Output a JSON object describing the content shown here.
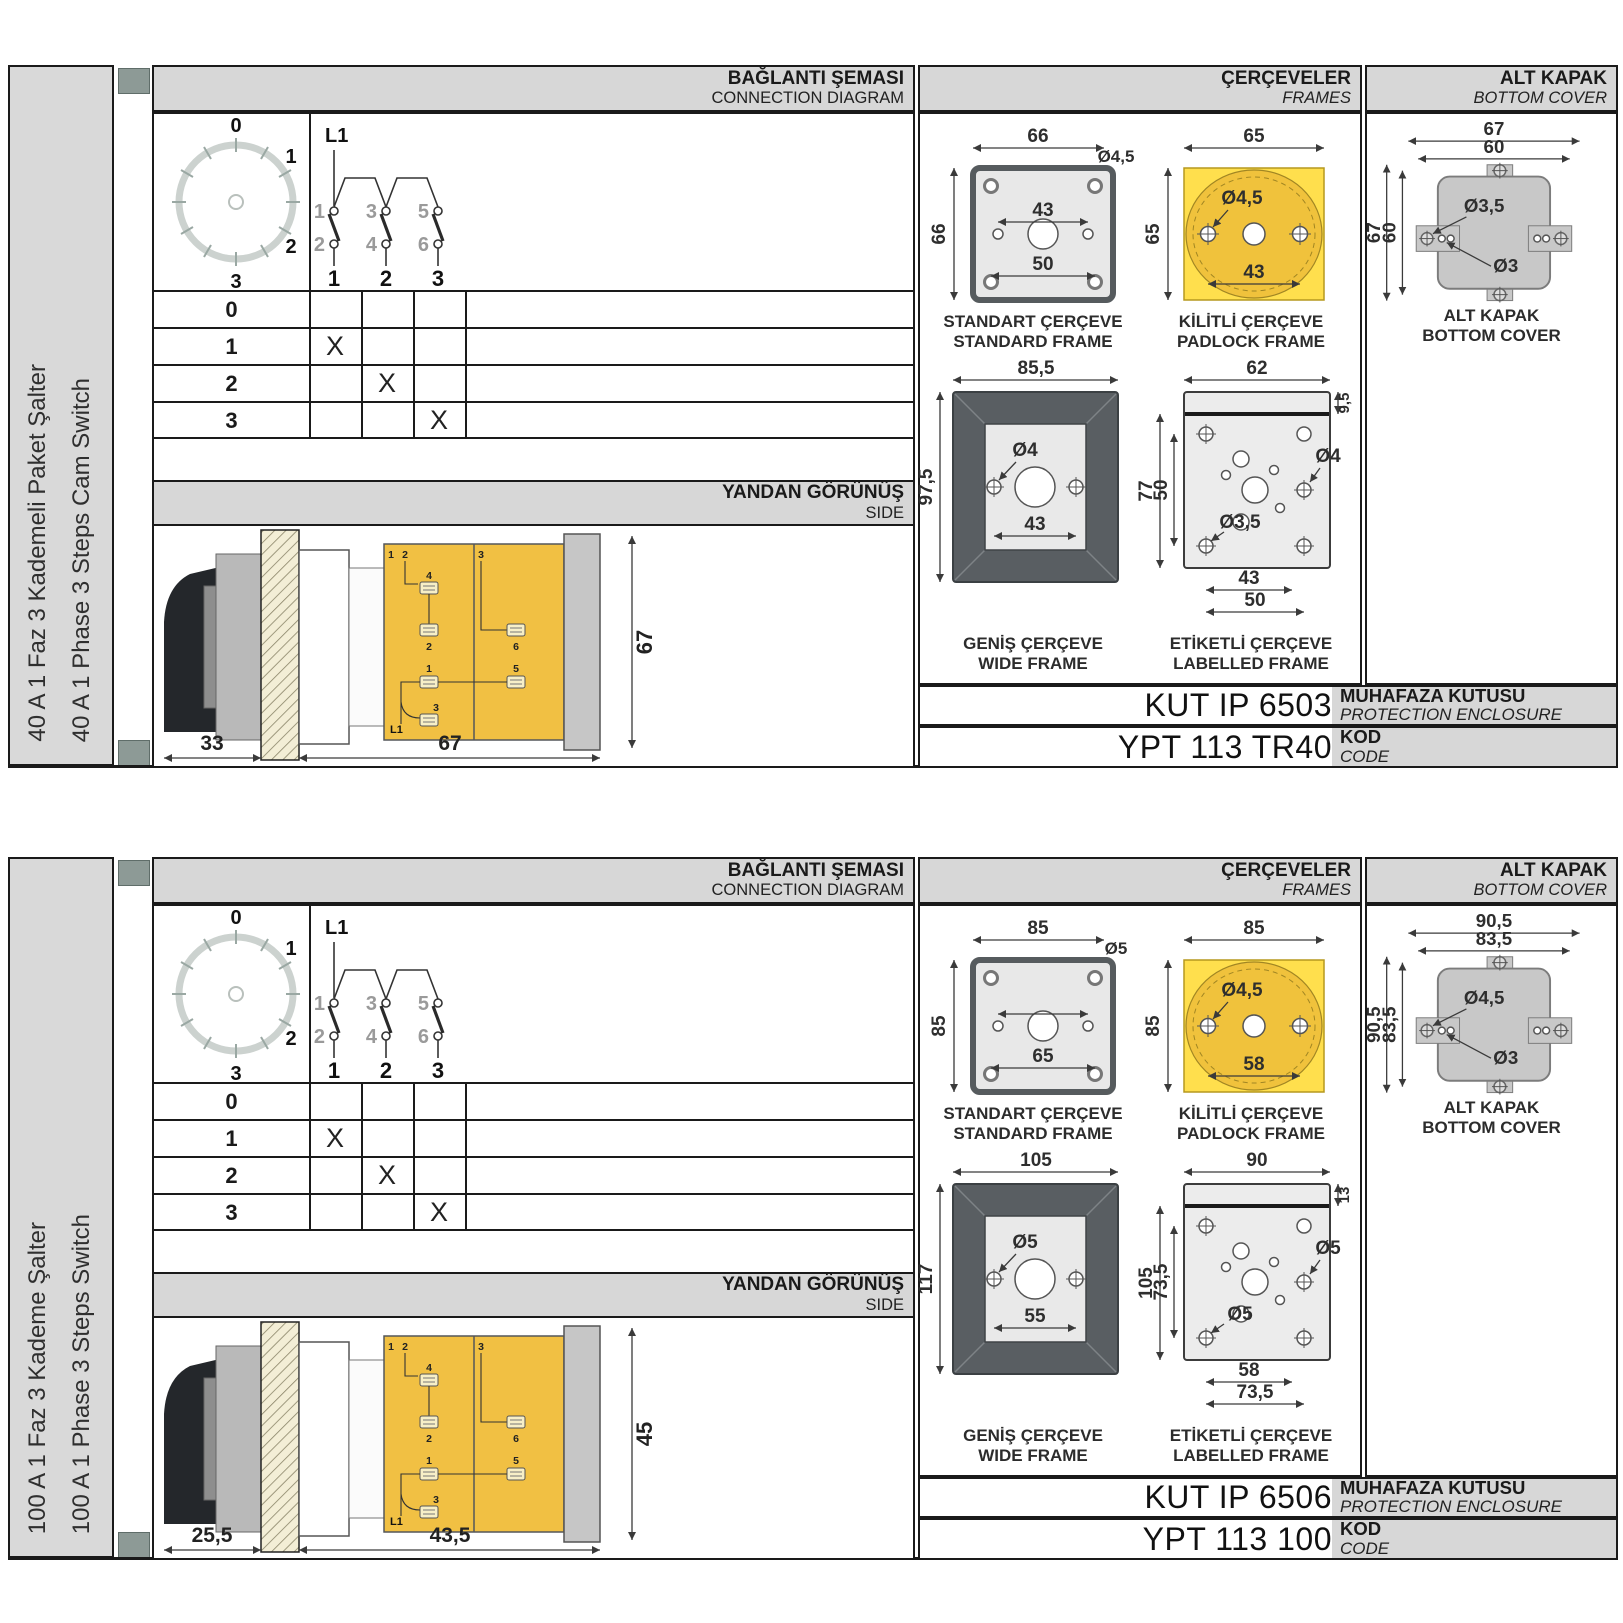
{
  "colors": {
    "panel_gray": "#d7d7d7",
    "body_yellow": "#f1c043",
    "padlock_yellow": "#ffdf4d",
    "frame_dark_gray": "#595e62",
    "tab_marker_green": "#8d9a96",
    "line_black": "#1a1a1a"
  },
  "sections": [
    {
      "sidebar": {
        "title_tr": "40 A 1 Faz 3 Kademeli Paket Şalter",
        "title_en": "40 A 1 Phase 3 Steps Cam Switch"
      },
      "headers": {
        "conn_tr": "BAĞLANTI ŞEMASI",
        "conn_en": "CONNECTION DIAGRAM",
        "frames_tr": "ÇERÇEVELER",
        "frames_en": "FRAMES",
        "cover_tr": "ALT KAPAK",
        "cover_en": "BOTTOM COVER"
      },
      "connection": {
        "phase_label": "L1",
        "dial_labels": [
          "0",
          "1",
          "2",
          "3"
        ],
        "contact_top": [
          "1",
          "3",
          "5"
        ],
        "contact_bottom": [
          "2",
          "4",
          "6"
        ],
        "outputs": [
          "1",
          "2",
          "3"
        ],
        "table": {
          "rows": [
            {
              "label": "0",
              "marks": [
                "",
                "",
                ""
              ]
            },
            {
              "label": "1",
              "marks": [
                "X",
                "",
                ""
              ]
            },
            {
              "label": "2",
              "marks": [
                "",
                "X",
                ""
              ]
            },
            {
              "label": "3",
              "marks": [
                "",
                "",
                "X"
              ]
            }
          ]
        }
      },
      "side": {
        "label_tr": "YANDAN GÖRÜNÜŞ",
        "label_en": "SIDE",
        "dim_front": "33",
        "dim_body": "67",
        "dim_height": "67",
        "terminals": {
          "tl1": "1",
          "tl2": "2",
          "t4": "4",
          "t2": "2",
          "t3": "3",
          "t6": "6",
          "b1": "1",
          "b5": "5",
          "b3": "3",
          "phase": "L1"
        }
      },
      "frames": {
        "standard": {
          "cap_tr": "STANDART ÇERÇEVE",
          "cap_en": "STANDARD FRAME",
          "dim_w": "66",
          "dim_h": "66",
          "dia": "Ø4,5",
          "dim_a": "43",
          "dim_b": "50"
        },
        "padlock": {
          "cap_tr": "KİLİTLİ ÇERÇEVE",
          "cap_en": "PADLOCK FRAME",
          "dim_w": "65",
          "dim_h": "65",
          "dia": "Ø4,5",
          "dim_a": "43"
        },
        "wide": {
          "cap_tr": "GENİŞ ÇERÇEVE",
          "cap_en": "WIDE FRAME",
          "dim_w": "85,5",
          "dim_h": "97,5",
          "dia": "Ø4",
          "dim_a": "43"
        },
        "labelled": {
          "cap_tr": "ETİKETLİ ÇERÇEVE",
          "cap_en": "LABELLED FRAME",
          "dim_w": "62",
          "dim_strip": "9,5",
          "dim_h": "77",
          "dim_inner": "50",
          "dia_a": "Ø4",
          "dia_b": "Ø3,5",
          "dim_a": "43",
          "dim_b": "50"
        }
      },
      "cover": {
        "cap_tr": "ALT KAPAK",
        "cap_en": "BOTTOM COVER",
        "dim_w1": "67",
        "dim_w2": "60",
        "dim_h1": "67",
        "dim_h2": "60",
        "dia_a": "Ø3,5",
        "dia_b": "Ø3"
      },
      "codes": {
        "enclosure": "KUT IP 6503",
        "enclosure_tr": "MUHAFAZA KUTUSU",
        "enclosure_en": "PROTECTION ENCLOSURE",
        "code": "YPT 113 TR40",
        "code_tr": "KOD",
        "code_en": "CODE"
      }
    },
    {
      "sidebar": {
        "title_tr": "100 A 1 Faz 3 Kademe Şalter",
        "title_en": "100 A 1 Phase 3 Steps Switch"
      },
      "headers": {
        "conn_tr": "BAĞLANTI ŞEMASI",
        "conn_en": "CONNECTION DIAGRAM",
        "frames_tr": "ÇERÇEVELER",
        "frames_en": "FRAMES",
        "cover_tr": "ALT KAPAK",
        "cover_en": "BOTTOM COVER"
      },
      "connection": {
        "phase_label": "L1",
        "dial_labels": [
          "0",
          "1",
          "2",
          "3"
        ],
        "contact_top": [
          "1",
          "3",
          "5"
        ],
        "contact_bottom": [
          "2",
          "4",
          "6"
        ],
        "outputs": [
          "1",
          "2",
          "3"
        ],
        "table": {
          "rows": [
            {
              "label": "0",
              "marks": [
                "",
                "",
                ""
              ]
            },
            {
              "label": "1",
              "marks": [
                "X",
                "",
                ""
              ]
            },
            {
              "label": "2",
              "marks": [
                "",
                "X",
                ""
              ]
            },
            {
              "label": "3",
              "marks": [
                "",
                "",
                "X"
              ]
            }
          ]
        }
      },
      "side": {
        "label_tr": "YANDAN GÖRÜNÜŞ",
        "label_en": "SIDE",
        "dim_front": "25,5",
        "dim_body": "43,5",
        "dim_height": "45",
        "terminals": {
          "tl1": "1",
          "tl2": "2",
          "t4": "4",
          "t2": "2",
          "t3": "3",
          "t6": "6",
          "b1": "1",
          "b5": "5",
          "b3": "3",
          "phase": "L1"
        }
      },
      "frames": {
        "standard": {
          "cap_tr": "STANDART ÇERÇEVE",
          "cap_en": "STANDARD FRAME",
          "dim_w": "85",
          "dim_h": "85",
          "dia": "Ø5",
          "dim_a": "",
          "dim_b": "65"
        },
        "padlock": {
          "cap_tr": "KİLİTLİ ÇERÇEVE",
          "cap_en": "PADLOCK FRAME",
          "dim_w": "85",
          "dim_h": "85",
          "dia": "Ø4,5",
          "dim_a": "58"
        },
        "wide": {
          "cap_tr": "GENİŞ ÇERÇEVE",
          "cap_en": "WIDE FRAME",
          "dim_w": "105",
          "dim_h": "117",
          "dia": "Ø5",
          "dim_a": "55"
        },
        "labelled": {
          "cap_tr": "ETİKETLİ ÇERÇEVE",
          "cap_en": "LABELLED FRAME",
          "dim_w": "90",
          "dim_strip": "13",
          "dim_h": "105",
          "dim_inner": "73,5",
          "dia_a": "Ø5",
          "dia_b": "Ø5",
          "dim_a": "58",
          "dim_b": "73,5"
        }
      },
      "cover": {
        "cap_tr": "ALT KAPAK",
        "cap_en": "BOTTOM COVER",
        "dim_w1": "90,5",
        "dim_w2": "83,5",
        "dim_h1": "90,5",
        "dim_h2": "83,5",
        "dia_a": "Ø4,5",
        "dia_b": "Ø3"
      },
      "codes": {
        "enclosure": "KUT IP 6506",
        "enclosure_tr": "MUHAFAZA KUTUSU",
        "enclosure_en": "PROTECTION ENCLOSURE",
        "code": "YPT 113 100",
        "code_tr": "KOD",
        "code_en": "CODE"
      }
    }
  ]
}
